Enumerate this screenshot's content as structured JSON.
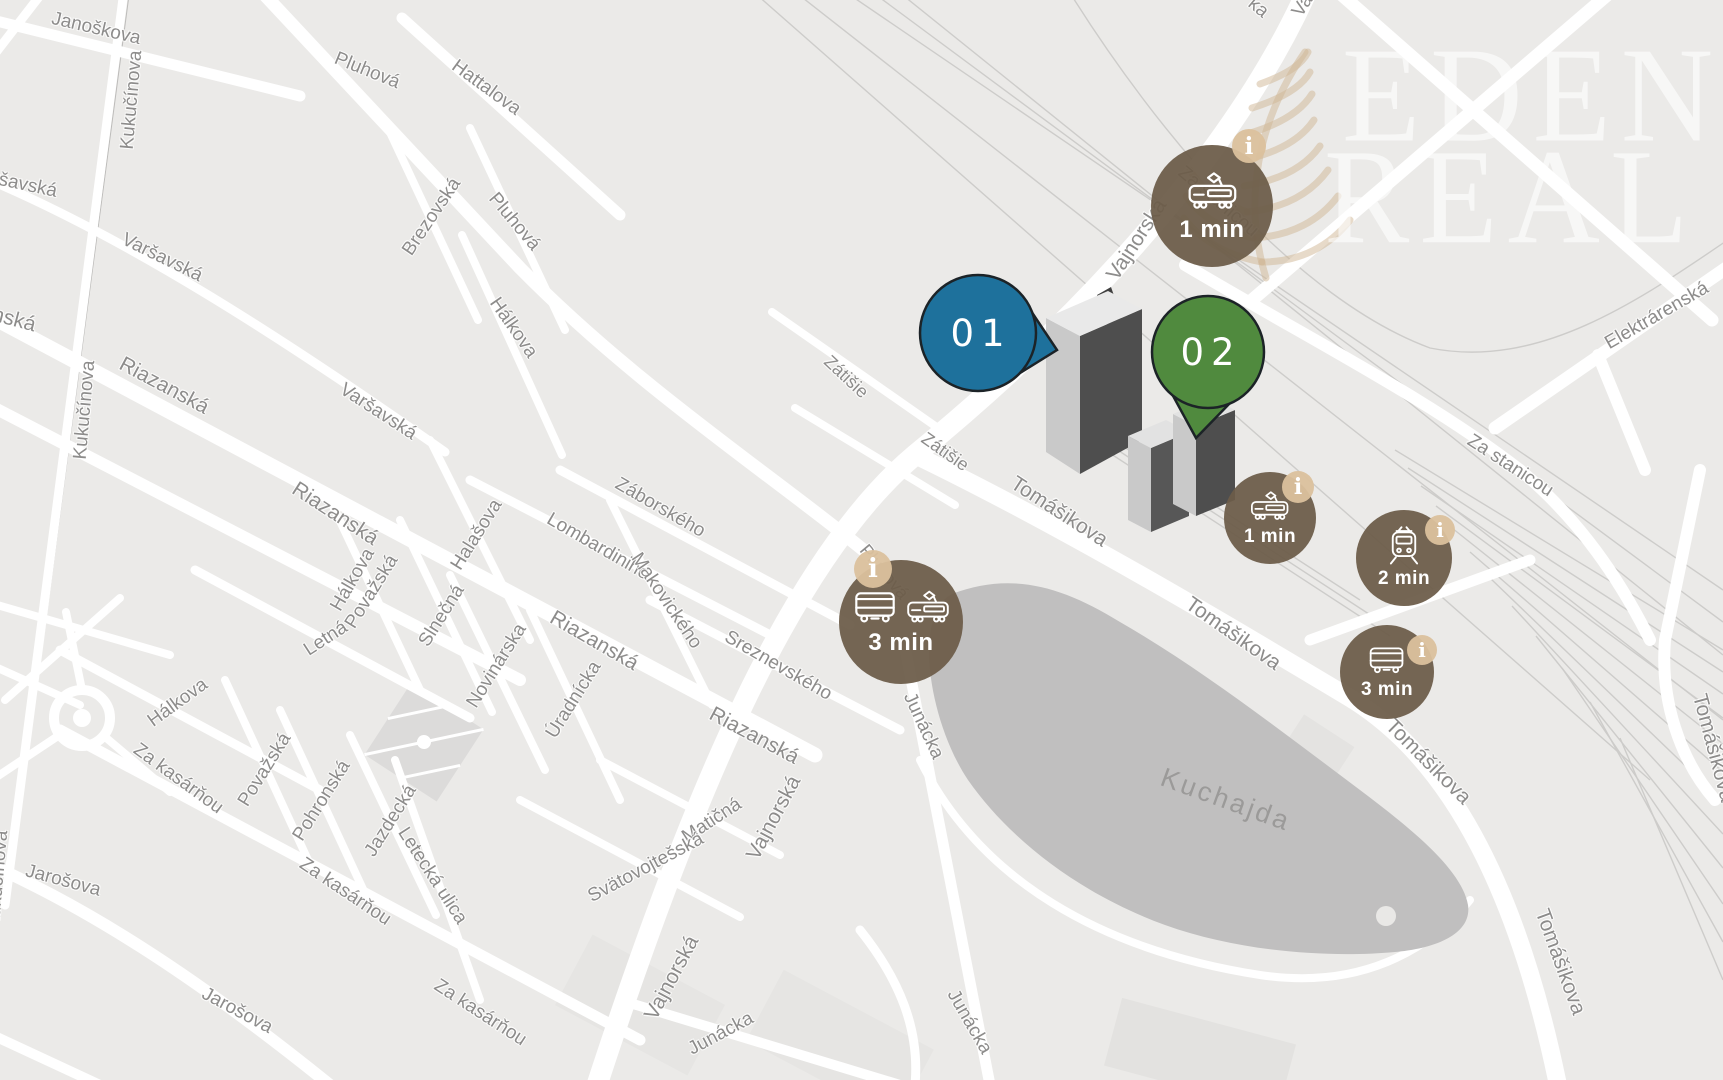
{
  "map": {
    "watermark": {
      "line1": "EDEN",
      "line2": "REAL"
    },
    "info_glyph": "i",
    "colors": {
      "background": "#ebeae8",
      "road": "#ffffff",
      "water": "#c0bfbf",
      "badge_brown": "#7a6b58",
      "info_tan": "#dbc19d",
      "pin_blue": "#1e719c",
      "pin_green": "#508a3e"
    },
    "pins": [
      {
        "id": "pin-01",
        "label": "01",
        "color": "#1e719c",
        "x": 978,
        "y": 333,
        "r": 58,
        "tail_points": "1033,314 1057,350 1020,373"
      },
      {
        "id": "pin-02",
        "label": "02",
        "color": "#508a3e",
        "x": 1208,
        "y": 352,
        "r": 56,
        "tail_points": "1231,402 1196,438 1172,394"
      }
    ],
    "transit_badges": [
      {
        "id": "badge-tram-1min-north",
        "time": "1 min",
        "icons": [
          "tram"
        ],
        "x": 1212,
        "y": 206,
        "r": 61,
        "font": 24,
        "icon_h": 46,
        "info": {
          "dx": 37,
          "dy": -60,
          "r": 17
        }
      },
      {
        "id": "badge-bus-tram-3min-west",
        "time": "3 min",
        "icons": [
          "bus",
          "tram"
        ],
        "x": 901,
        "y": 622,
        "r": 62,
        "font": 24,
        "icon_h": 40,
        "info": {
          "dx": -28,
          "dy": -53,
          "r": 19
        }
      },
      {
        "id": "badge-tram-1min-east",
        "time": "1 min",
        "icons": [
          "tram"
        ],
        "x": 1270,
        "y": 518,
        "r": 46,
        "font": 19,
        "icon_h": 36,
        "info": {
          "dx": 28,
          "dy": -31,
          "r": 16
        }
      },
      {
        "id": "badge-train-2min",
        "time": "2 min",
        "icons": [
          "train"
        ],
        "x": 1404,
        "y": 558,
        "r": 48,
        "font": 19,
        "icon_h": 40,
        "info": {
          "dx": 36,
          "dy": -28,
          "r": 15
        }
      },
      {
        "id": "badge-bus-3min-east",
        "time": "3 min",
        "icons": [
          "bus"
        ],
        "x": 1387,
        "y": 672,
        "r": 47,
        "font": 19,
        "icon_h": 34,
        "info": {
          "dx": 35,
          "dy": -22,
          "r": 15
        }
      }
    ],
    "street_labels": [
      {
        "text": "Janoškova",
        "x": 96,
        "y": 29,
        "rot": 13,
        "size": 19
      },
      {
        "text": "Kukučínova",
        "x": 132,
        "y": 100,
        "rot": -85,
        "size": 19
      },
      {
        "text": "Pluhová",
        "x": 367,
        "y": 71,
        "rot": 22,
        "size": 19
      },
      {
        "text": "Hattalova",
        "x": 486,
        "y": 88,
        "rot": 36,
        "size": 19
      },
      {
        "text": "Varšavská",
        "x": 14,
        "y": 183,
        "rot": 12,
        "size": 19
      },
      {
        "text": "Varšavská",
        "x": 162,
        "y": 258,
        "rot": 26,
        "size": 19
      },
      {
        "text": "Brezovská",
        "x": 432,
        "y": 217,
        "rot": -56,
        "size": 19
      },
      {
        "text": "Pluhová",
        "x": 514,
        "y": 222,
        "rot": 50,
        "size": 19
      },
      {
        "text": "Hálkova",
        "x": 513,
        "y": 328,
        "rot": 55,
        "size": 19
      },
      {
        "text": "Riazanská",
        "x": -12,
        "y": 313,
        "rot": 15,
        "size": 21
      },
      {
        "text": "Kukučínova",
        "x": 85,
        "y": 410,
        "rot": -85,
        "size": 19
      },
      {
        "text": "Riazanská",
        "x": 164,
        "y": 386,
        "rot": 28,
        "size": 21
      },
      {
        "text": "Varšavská",
        "x": 378,
        "y": 412,
        "rot": 33,
        "size": 19
      },
      {
        "text": "Riazanská",
        "x": 335,
        "y": 514,
        "rot": 33,
        "size": 21
      },
      {
        "text": "Hálkova",
        "x": 353,
        "y": 580,
        "rot": -60,
        "size": 19
      },
      {
        "text": "Považská",
        "x": 372,
        "y": 592,
        "rot": -58,
        "size": 19
      },
      {
        "text": "Halašova",
        "x": 477,
        "y": 535,
        "rot": -58,
        "size": 19
      },
      {
        "text": "Slnečná",
        "x": 442,
        "y": 616,
        "rot": -58,
        "size": 19
      },
      {
        "text": "Záborského",
        "x": 660,
        "y": 508,
        "rot": 30,
        "size": 19
      },
      {
        "text": "Lombardiniho",
        "x": 598,
        "y": 547,
        "rot": 30,
        "size": 19
      },
      {
        "text": "Makovického",
        "x": 666,
        "y": 601,
        "rot": 56,
        "size": 19
      },
      {
        "text": "Sreznevského",
        "x": 778,
        "y": 666,
        "rot": 30,
        "size": 19
      },
      {
        "text": "Riazanská",
        "x": 594,
        "y": 641,
        "rot": 30,
        "size": 21
      },
      {
        "text": "Novinárska",
        "x": 497,
        "y": 666,
        "rot": -58,
        "size": 19
      },
      {
        "text": "Úradnícka",
        "x": 574,
        "y": 700,
        "rot": -58,
        "size": 19
      },
      {
        "text": "Hálkova",
        "x": 178,
        "y": 703,
        "rot": -36,
        "size": 19
      },
      {
        "text": "Za kasárňou",
        "x": 178,
        "y": 779,
        "rot": 36,
        "size": 19
      },
      {
        "text": "Letná",
        "x": 326,
        "y": 639,
        "rot": -33,
        "size": 19
      },
      {
        "text": "Považská",
        "x": 265,
        "y": 770,
        "rot": -58,
        "size": 19
      },
      {
        "text": "Pohronská",
        "x": 322,
        "y": 801,
        "rot": -58,
        "size": 19
      },
      {
        "text": "Jazdecká",
        "x": 391,
        "y": 821,
        "rot": -58,
        "size": 19
      },
      {
        "text": "Letecká ulica",
        "x": 432,
        "y": 876,
        "rot": 57,
        "size": 19
      },
      {
        "text": "Za kasárňou",
        "x": 345,
        "y": 892,
        "rot": 34,
        "size": 19
      },
      {
        "text": "Jarošova",
        "x": 63,
        "y": 881,
        "rot": 15,
        "size": 19
      },
      {
        "text": "Kukučínova",
        "x": -2,
        "y": 880,
        "rot": -85,
        "size": 19
      },
      {
        "text": "Jarošova",
        "x": 237,
        "y": 1011,
        "rot": 28,
        "size": 19
      },
      {
        "text": "Za kasárňou",
        "x": 480,
        "y": 1013,
        "rot": 33,
        "size": 19
      },
      {
        "text": "Zátišie",
        "x": 846,
        "y": 377,
        "rot": 43,
        "size": 18
      },
      {
        "text": "Zátišie",
        "x": 945,
        "y": 452,
        "rot": 35,
        "size": 18
      },
      {
        "text": "Pluhová",
        "x": 884,
        "y": 572,
        "rot": 50,
        "size": 18
      },
      {
        "text": "Riazanská",
        "x": 754,
        "y": 736,
        "rot": 28,
        "size": 21
      },
      {
        "text": "Vajnorská",
        "x": 774,
        "y": 818,
        "rot": -62,
        "size": 21
      },
      {
        "text": "Matičná",
        "x": 712,
        "y": 821,
        "rot": -33,
        "size": 19
      },
      {
        "text": "Svätovojtešská",
        "x": 646,
        "y": 868,
        "rot": -28,
        "size": 19
      },
      {
        "text": "Vajnorská",
        "x": 672,
        "y": 978,
        "rot": -62,
        "size": 21
      },
      {
        "text": "Junácka",
        "x": 721,
        "y": 1034,
        "rot": -28,
        "size": 19
      },
      {
        "text": "Junácka",
        "x": 923,
        "y": 726,
        "rot": 65,
        "size": 19
      },
      {
        "text": "Junácka",
        "x": 969,
        "y": 1022,
        "rot": 60,
        "size": 19
      },
      {
        "text": "Vajnorská",
        "x": 1137,
        "y": 240,
        "rot": -57,
        "size": 21
      },
      {
        "text": "Za stanicou",
        "x": 1218,
        "y": 202,
        "rot": 40,
        "size": 19
      },
      {
        "text": "Tomášikova",
        "x": 1059,
        "y": 512,
        "rot": 33,
        "size": 21
      },
      {
        "text": "Tomášikova",
        "x": 1233,
        "y": 634,
        "rot": 35,
        "size": 21
      },
      {
        "text": "Tomášikova",
        "x": 1428,
        "y": 762,
        "rot": 45,
        "size": 21
      },
      {
        "text": "Tomášikova",
        "x": 1560,
        "y": 962,
        "rot": 70,
        "size": 21
      },
      {
        "text": "Tomášikova",
        "x": 1713,
        "y": 748,
        "rot": 75,
        "size": 21
      },
      {
        "text": "Za stanicou",
        "x": 1510,
        "y": 466,
        "rot": 33,
        "size": 19
      },
      {
        "text": "Elektrárenská",
        "x": 1657,
        "y": 316,
        "rot": -30,
        "size": 19
      },
      {
        "text": "Va",
        "x": 1303,
        "y": 6,
        "rot": -57,
        "size": 19
      },
      {
        "text": "ka",
        "x": 1258,
        "y": 8,
        "rot": 40,
        "size": 19
      },
      {
        "text": "Kuchajda",
        "x": 1226,
        "y": 800,
        "rot": 20,
        "size": 27,
        "kind": "water"
      }
    ]
  }
}
